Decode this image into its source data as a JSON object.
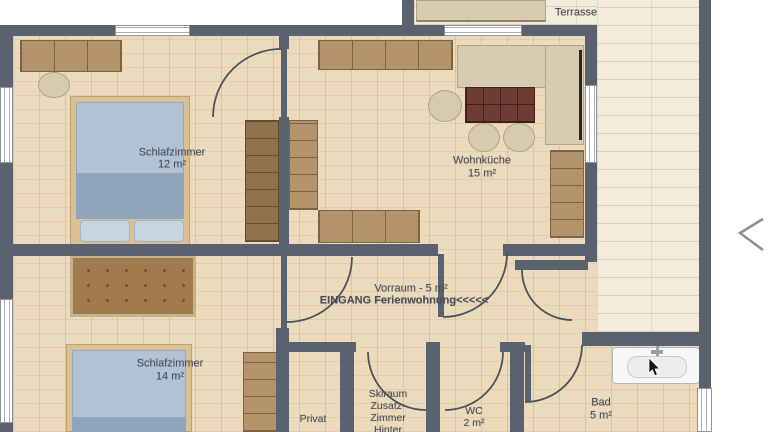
{
  "title": "Ferienwohnung floor plan",
  "labels": {
    "terrasse": "Terrasse",
    "schlafzimmer1": {
      "name": "Schlafzimmer",
      "area": "12 m²"
    },
    "wohnkueche": {
      "name": "Wohnküche",
      "area": "15 m²"
    },
    "vorraum": {
      "line1": "Vorraum - 5 m²",
      "line2": "EINGANG Ferienwohnung<<<<<"
    },
    "schlafzimmer2": {
      "name": "Schlafzimmer",
      "area": "14 m²"
    },
    "privat": "Privat",
    "skiraum": {
      "line1": "Skiraum",
      "line2": "Zusatz-",
      "line3": "Zimmer",
      "line4": "Hinter"
    },
    "wc": {
      "name": "WC",
      "area": "2 m²"
    },
    "bad": {
      "name": "Bad",
      "area": "5 m²"
    }
  },
  "icons": {
    "chevron_left": "previous-image arrow",
    "mouse_cursor": "pointer over bathroom sink"
  },
  "colors": {
    "wall": "#5a6270",
    "indoor_floor": "#ecdabc",
    "terrace_deck": "#f4ecdb",
    "bed_blanket": "#b3c3d6",
    "bed_frame": "#dac194",
    "sofa_beige": "#d5ccb2",
    "dining_table": "#6d3c34",
    "cabinet_wood": "#b3946a",
    "wardrobe_dark": "#8f714c",
    "tufted_sofa": "#a07b4e",
    "label_text": "#474d59",
    "background": "#ffffff"
  }
}
